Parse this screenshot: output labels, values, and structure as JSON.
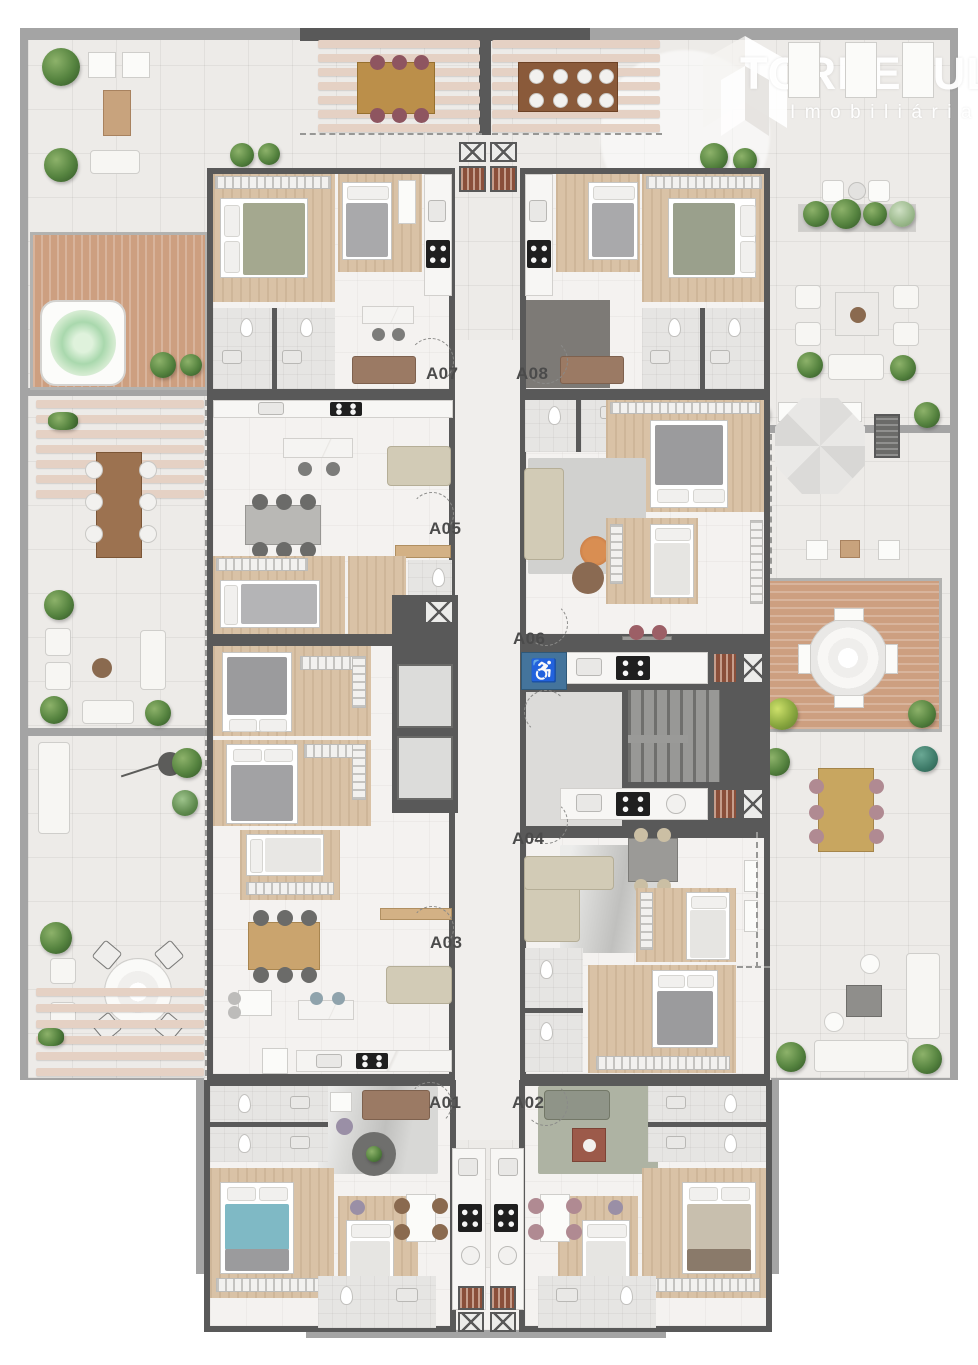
{
  "meta": {
    "type": "architectural floor plan",
    "view": "top-down 3D render",
    "building": "residential floor with 8 apartments and wrap-around terraces"
  },
  "watermark": {
    "brand": "TORRESUL",
    "tagline": "Imobiliária"
  },
  "units": [
    {
      "id": "A01"
    },
    {
      "id": "A02"
    },
    {
      "id": "A03"
    },
    {
      "id": "A04"
    },
    {
      "id": "A05"
    },
    {
      "id": "A06"
    },
    {
      "id": "A07"
    },
    {
      "id": "A08"
    }
  ],
  "core": {
    "accessible_sign": "♿"
  },
  "colors": {
    "outer_wall": "#a4a4a4",
    "inner_wall": "#595959",
    "terrace_floor": "#edebe8",
    "interior_floor": "#f4f2f0",
    "wood_floor": "#d9c2a6",
    "deck_wood": "#cd9f80",
    "pergola_slat": "#e5d1c4",
    "plant_green": "#55833f",
    "accessible_blue": "#44749c",
    "teal_bed": "#7fb9c5",
    "sofa_beige": "#d2cbb6",
    "sofa_brown": "#9b7a64"
  },
  "amenities": [
    "hot-tub",
    "pergola-dining",
    "outdoor-lounge",
    "parasol-lounge",
    "barbecue-grill",
    "planter-garden",
    "round-dining-deck",
    "stairs",
    "elevators",
    "accessible-wc"
  ]
}
